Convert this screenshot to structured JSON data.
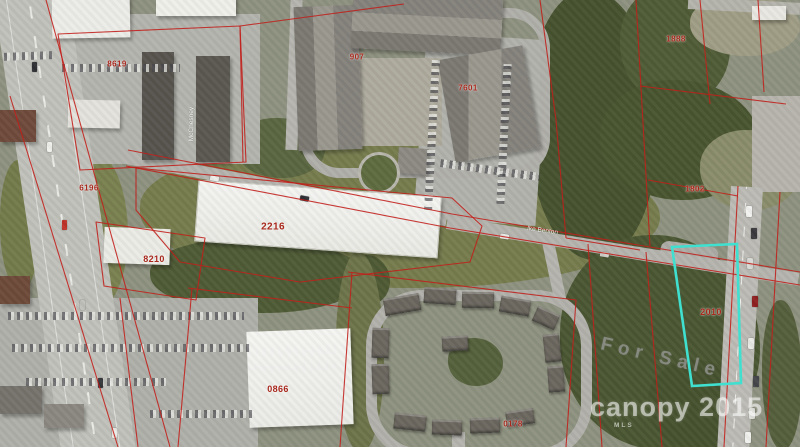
{
  "map": {
    "selected_parcel": {
      "id": "2010",
      "outline_color": "#3fe0d0"
    },
    "parcel_labels": [
      {
        "id": "8619",
        "x": 117,
        "y": 64,
        "size": 8
      },
      {
        "id": "6196",
        "x": 89,
        "y": 188,
        "size": 8
      },
      {
        "id": "907",
        "x": 357,
        "y": 57,
        "size": 8
      },
      {
        "id": "7601",
        "x": 468,
        "y": 88,
        "size": 8
      },
      {
        "id": "2216",
        "x": 273,
        "y": 227,
        "size": 10
      },
      {
        "id": "8210",
        "x": 154,
        "y": 259,
        "size": 9
      },
      {
        "id": "0866",
        "x": 278,
        "y": 389,
        "size": 9
      },
      {
        "id": "0178",
        "x": 513,
        "y": 424,
        "size": 8
      },
      {
        "id": "1888",
        "x": 676,
        "y": 39,
        "size": 8
      },
      {
        "id": "1802",
        "x": 695,
        "y": 189,
        "size": 8
      },
      {
        "id": "2010",
        "x": 711,
        "y": 312,
        "size": 9
      }
    ],
    "road_labels": [
      {
        "text": "Ike Benton",
        "x": 527,
        "y": 226,
        "rot": 8
      },
      {
        "text": "McChesney",
        "x": 192,
        "y": 138,
        "rot": -90
      }
    ],
    "watermark": {
      "for_sale": "For Sale",
      "brand": "canopy",
      "year": "2015",
      "mls": "MLS"
    },
    "colors": {
      "parcel_line": "#c21f1a",
      "highlight": "#3fe0d0",
      "label": "#a8281c"
    }
  }
}
